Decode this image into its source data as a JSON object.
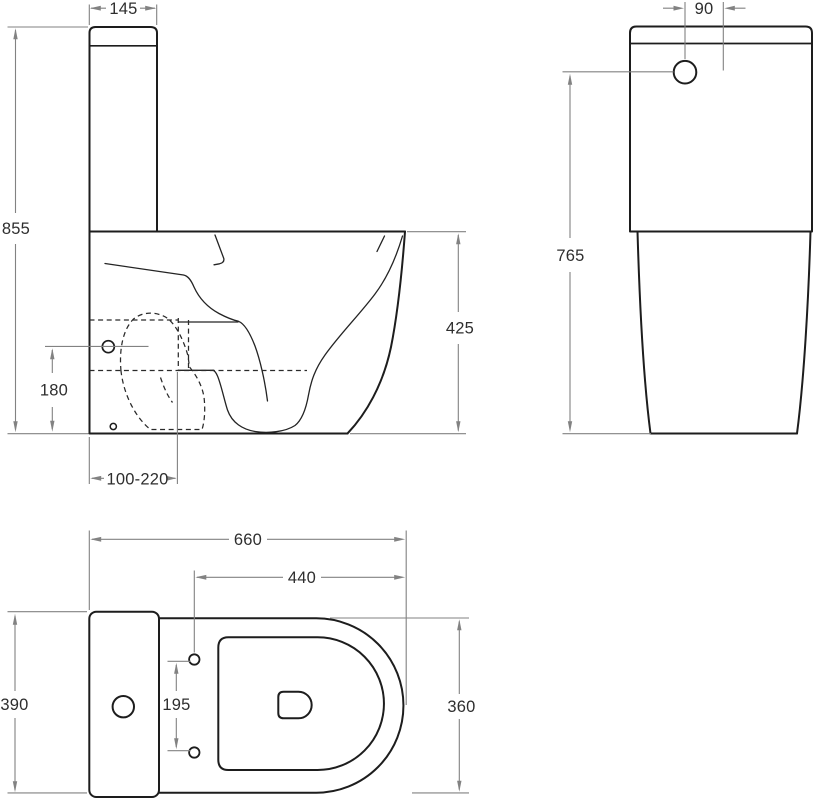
{
  "drawing_type": "sanitary-ware dimensional drawing",
  "background": "#ffffff",
  "colors": {
    "outline": "#1d1d1d",
    "dimension_lines": "#828282",
    "label_text": "#2e2e2e"
  },
  "views": {
    "side": {
      "labels": {
        "tank_width": "145",
        "total_height": "855",
        "bowl_height": "425",
        "inlet_height": "180",
        "outlet_rough_in": "100-220"
      }
    },
    "front": {
      "labels": {
        "button_offset": "90",
        "button_height": "765"
      }
    },
    "plan": {
      "labels": {
        "total_depth": "660",
        "bolts_to_front": "440",
        "back_width": "390",
        "bolt_spacing": "195",
        "bowl_width": "360"
      }
    }
  }
}
